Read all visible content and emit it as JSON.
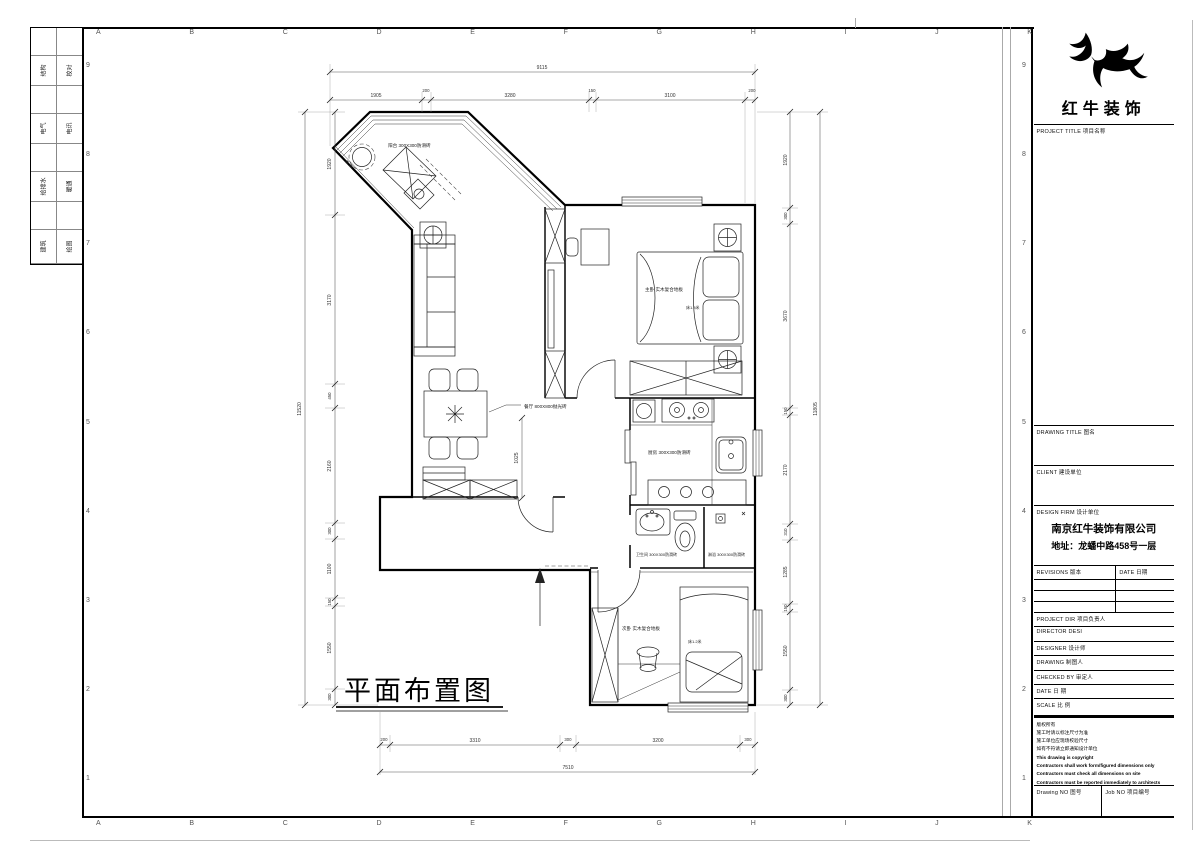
{
  "sheet": {
    "grid_letters": [
      "A",
      "B",
      "C",
      "D",
      "E",
      "F",
      "G",
      "H",
      "I",
      "J",
      "K"
    ],
    "grid_numbers": [
      "9",
      "8",
      "7",
      "6",
      "5",
      "4",
      "3",
      "2",
      "1"
    ]
  },
  "sign_strip": {
    "rows": [
      {
        "a": "结构",
        "b": "校对"
      },
      {
        "a": "电气",
        "b": "电讯"
      },
      {
        "a": "给排水",
        "b": "暖通"
      },
      {
        "a": "建筑",
        "b": "绘图"
      }
    ]
  },
  "title_block": {
    "logo_text": "红牛装饰",
    "project_title_label": "PROJECT TITLE  项目名称",
    "drawing_title_label": "DRAWING TITLE  图名",
    "client_label": "CLIENT  建设单位",
    "design_firm_label": "DESIGN FIRM  设计单位",
    "firm_name": "南京红牛装饰有限公司",
    "firm_address": "地址：龙蟠中路458号一层",
    "revisions_label": "REVISIONS  版本",
    "date_col_label": "DATE  日期",
    "project_dir_label": "PROJECT DIR   项目负责人",
    "director_label": "DIRECTOR DESI",
    "designer_label": "DESIGNER      设计师",
    "drawing_label": "DRAWING       制图人",
    "checked_label": "CHECKED BY    审定人",
    "date_label": "DATE          日  期",
    "scale_label": "SCALE         比  例",
    "copyright_cn": [
      "版权所有",
      "施工时请以标注尺寸为准",
      "施工单位应现场校验尺寸",
      "如有不符请立即通知设计单位"
    ],
    "copyright_en": [
      "This drawing is copyright",
      "Contractors shall work form/figured dimensions only",
      "Contractors must check all dimensions on site",
      "Contractors must be reported immediately to architects"
    ],
    "drawing_no_label": "Drawing NO  图号",
    "job_no_label": "Job NO  项目编号"
  },
  "plan": {
    "title": "平面布置图",
    "rooms": {
      "balcony": "阳台 300X300防滑砖",
      "master": "主卧 实木复合地板",
      "master_bed": "床1.8米",
      "dining": "餐厅 800X800抛光砖",
      "kitchen": "厨房 300X300防滑砖",
      "bath": "卫生间 300X300防滑砖",
      "shower": "淋浴 300X300防滑砖",
      "second": "次卧 实木复合地板",
      "second_bed": "床1.2米"
    },
    "dims": {
      "top_total": "9115",
      "top": [
        "1905",
        "200",
        "3280",
        "150",
        "3100",
        "200"
      ],
      "bottom": [
        "200",
        "3310",
        "300",
        "3200",
        "300"
      ],
      "bottom_total": "7510",
      "left": [
        "1920",
        "3170",
        "450",
        "2160",
        "300",
        "1100",
        "150",
        "1550",
        "300"
      ],
      "left_total": "11520",
      "right": [
        "1920",
        "300",
        "3670",
        "150",
        "2170",
        "310",
        "1285",
        "150",
        "1550",
        "300"
      ],
      "right_total": "11805",
      "hall": "1025"
    }
  }
}
